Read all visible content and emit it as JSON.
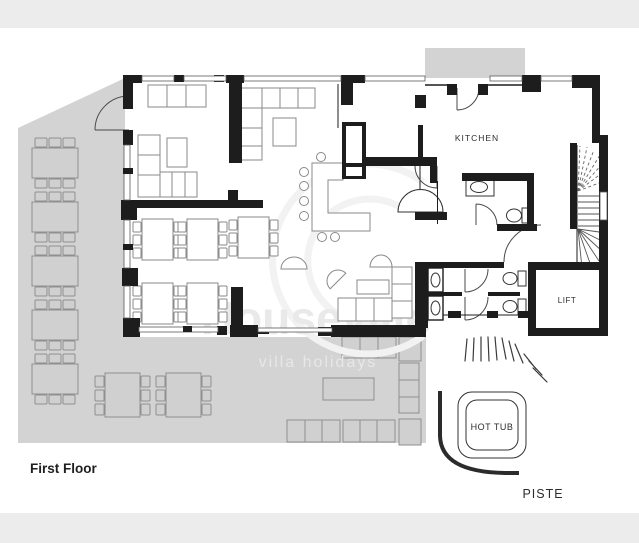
{
  "labels": {
    "floor": "First Floor",
    "kitchen": "KITCHEN",
    "lift": "LIFT",
    "hot_tub": "HOT TUB",
    "piste": "PISTE"
  },
  "watermark": {
    "line1": "Houseville",
    "line2": "villa holidays"
  },
  "colors": {
    "background": "#ffffff",
    "band": "#ececec",
    "terrace": "#d3d3d3",
    "wall": "#1d1d1d",
    "furniture_outline": "#8a8a8a",
    "label_text": "#2d2d2d",
    "watermark_text": "#e9e9e9"
  }
}
